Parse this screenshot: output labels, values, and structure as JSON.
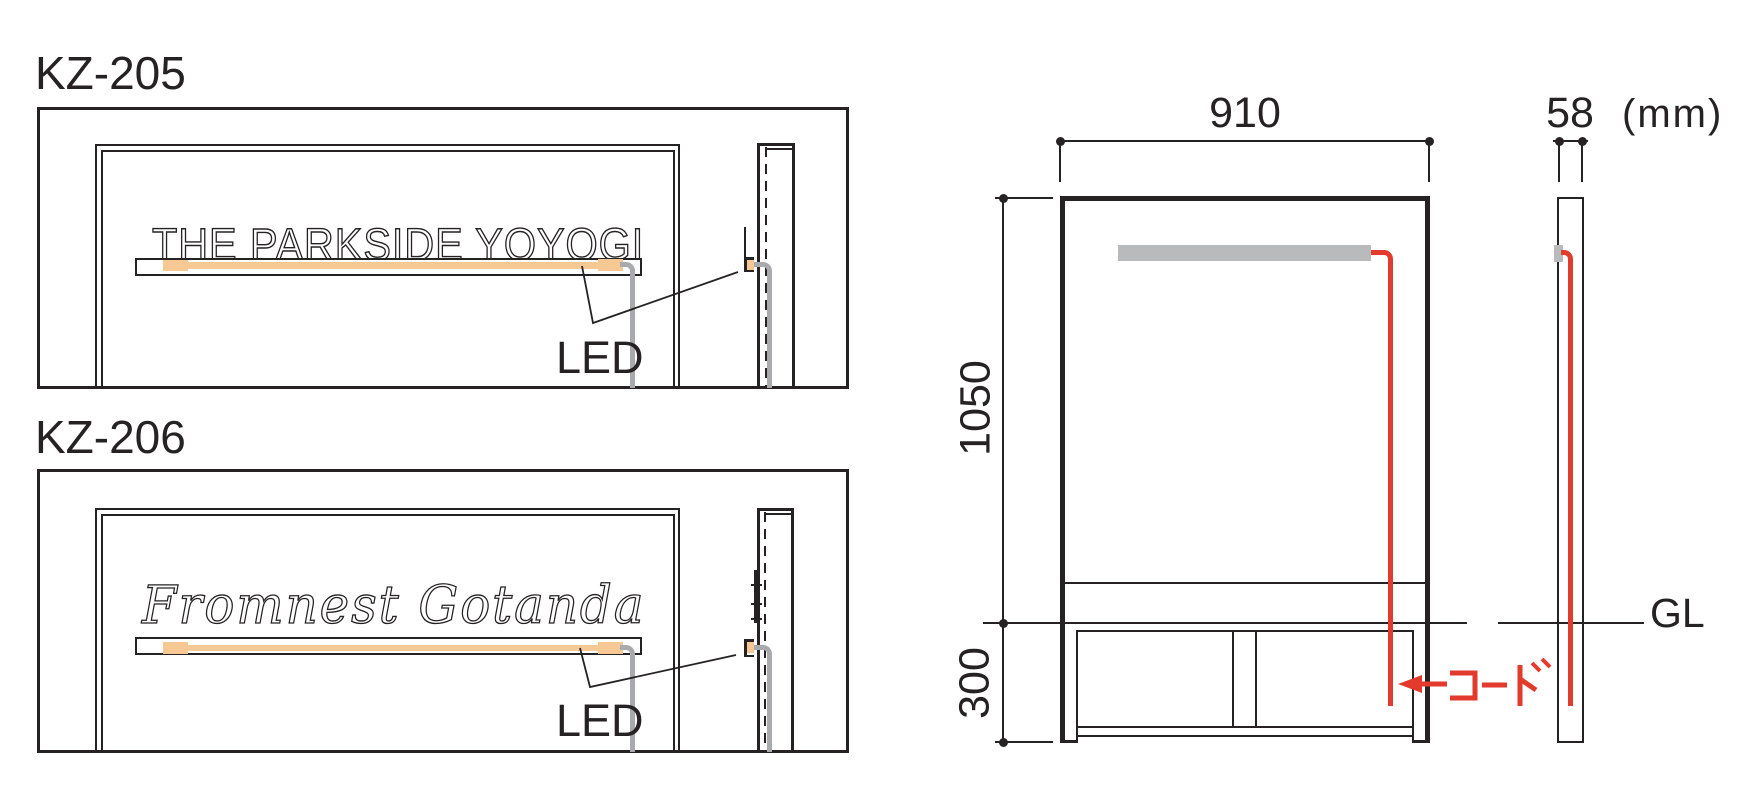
{
  "page": {
    "background": "#ffffff"
  },
  "products": [
    {
      "model": "KZ-205",
      "sign_text": "THE PARKSIDE YOYOGI",
      "sign_style": "outlined capital letters on lit shelf",
      "led_label": "LED"
    },
    {
      "model": "KZ-206",
      "sign_text": "Fromnest Gotanda",
      "sign_style": "outlined script letters on lit shelf",
      "led_label": "LED"
    }
  ],
  "dimension_figure": {
    "width_label": "910",
    "depth_label": "58",
    "unit_label": "(mm)",
    "height_label": "1050",
    "embed_depth_label": "300",
    "ground_line_label": "GL",
    "cord_label": "コード"
  },
  "colors": {
    "line": "#262223",
    "led_strip_orange": "#f6c894",
    "led_bar_gray": "#b9babc",
    "cord_gray": "#a8aaad",
    "cord_red": "#e23a2d"
  }
}
